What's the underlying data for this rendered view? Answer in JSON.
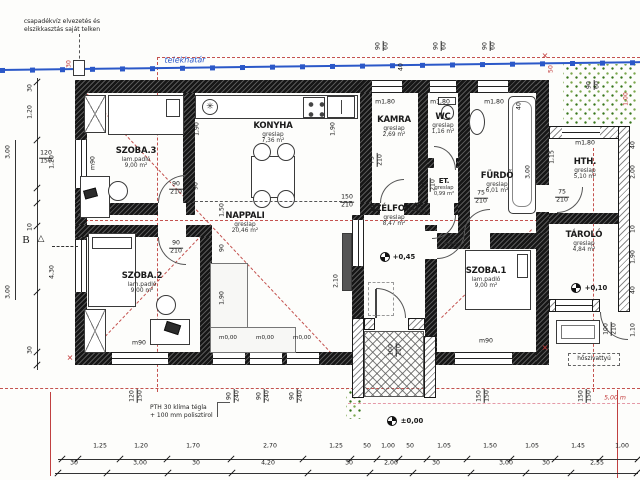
{
  "annotations": {
    "drain_note_line1": "csapadékvíz elvezetés és",
    "drain_note_line2": "elszikkasztás saját telken",
    "boundary_label": "telekhatár",
    "wall_note_line1": "PTH 30 klíma tégla",
    "wall_note_line2": "+ 100 mm polisztirol",
    "heat_pump_label": "hőszivattyú",
    "distance_label": "5,00 m",
    "section_label": "B",
    "section_triangle": "△"
  },
  "icons": {
    "boiler": "✳",
    "survey_cross": "✕"
  },
  "rooms": [
    {
      "name": "SZOBA.3",
      "floor": "lam.padló",
      "area": "9,00 m²"
    },
    {
      "name": "KONYHA",
      "floor": "greslap",
      "area": "7,36 m²"
    },
    {
      "name": "KAMRA",
      "floor": "greslap",
      "area": "2,69 m²"
    },
    {
      "name": "WC",
      "floor": "greslap",
      "area": "1,16 m²"
    },
    {
      "name": "FÜRDŐ",
      "floor": "greslap",
      "area": "6,01 m²"
    },
    {
      "name": "HTH.",
      "floor": "greslap",
      "area": "5,10 m²"
    },
    {
      "name": "ET.",
      "floor": "greslap",
      "area": "0,99 m²"
    },
    {
      "name": "SZÉLFOGÓ",
      "floor": "greslap",
      "area": "8,47 m²"
    },
    {
      "name": "NAPPALI",
      "floor": "greslap",
      "area": "20,46 m²"
    },
    {
      "name": "SZOBA.2",
      "floor": "lam.padló",
      "area": "9,00 m²"
    },
    {
      "name": "SZOBA.1",
      "floor": "lam.padló",
      "area": "9,00 m²"
    },
    {
      "name": "TÁROLÓ",
      "floor": "greslap",
      "area": "4,84 m²"
    }
  ],
  "levels": {
    "entry": "+0,45",
    "storage": "+0,10",
    "ground": "±0,00"
  },
  "openings": {
    "szoba3_door": {
      "w": "90",
      "h": "210"
    },
    "szoba2_door": {
      "w": "90",
      "h": "210"
    },
    "szoba1_door": {
      "w": "90",
      "h": "210"
    },
    "kamra_door": {
      "w": "75",
      "h": "210"
    },
    "wc_door": {
      "w": "75",
      "h": "210"
    },
    "furdo_door": {
      "w": "75",
      "h": "210"
    },
    "et_door": {
      "w": "75",
      "h": "210"
    },
    "hth_door": {
      "w": "75",
      "h": "210"
    },
    "entry_door": {
      "w": "100",
      "h": "210"
    },
    "tarolo_door": {
      "w": "100",
      "h": "210"
    },
    "szoba3_window": {
      "w": "120",
      "h": "150"
    },
    "szelfogo_window": {
      "w": "150",
      "h": "210"
    }
  },
  "sills": {
    "szoba3": "m90",
    "szoba2": "m90",
    "szoba1": "m90",
    "kamra": "m1,80",
    "wc": "m1,80",
    "furdo": "m1,80",
    "hth": "m1,80",
    "nappali": [
      "m0,00",
      "m0,00",
      "m0,00"
    ]
  },
  "dims": {
    "bottom_row1": [
      "1,25",
      "1,20",
      "1,70",
      "2,70",
      "1,25",
      "50",
      "1,00",
      "50",
      "1,05",
      "1,50",
      "1,05",
      "1,45",
      "1,00"
    ],
    "bottom_row2": [
      "30",
      "3,00",
      "30",
      "4,20",
      "30",
      "2,00",
      "30",
      "3,00",
      "30",
      "2,55"
    ],
    "left_chain": [
      "30",
      "1,20",
      "3,00",
      "1,20",
      "10",
      "4,30",
      "3,00",
      "30"
    ],
    "right_chain": [
      "40",
      "2,00",
      "10",
      "1,90",
      "40",
      "1,10"
    ],
    "top_windows": [
      {
        "w": "90",
        "h": "60"
      },
      {
        "w": "90",
        "h": "60"
      },
      {
        "w": "90",
        "h": "60"
      },
      {
        "w": "90",
        "h": "60"
      }
    ],
    "bottom_openings": [
      {
        "w": "120",
        "h": "150"
      },
      {
        "w": "90",
        "h": "240"
      },
      {
        "w": "90",
        "h": "240"
      },
      {
        "w": "90",
        "h": "240"
      },
      {
        "w": "150",
        "h": "150"
      },
      {
        "w": "150",
        "h": "150"
      }
    ],
    "misc": {
      "eave30": "30",
      "eave50": "50",
      "right100": "1,00",
      "stove40": "40",
      "tub40": "40",
      "tub300": "3,00",
      "d115": "1,15",
      "k190": "1,90",
      "k90": "90",
      "kr190": "1,90",
      "n150": "1,50",
      "n90": "90",
      "n190": "1,90",
      "s210": "2,10"
    }
  }
}
